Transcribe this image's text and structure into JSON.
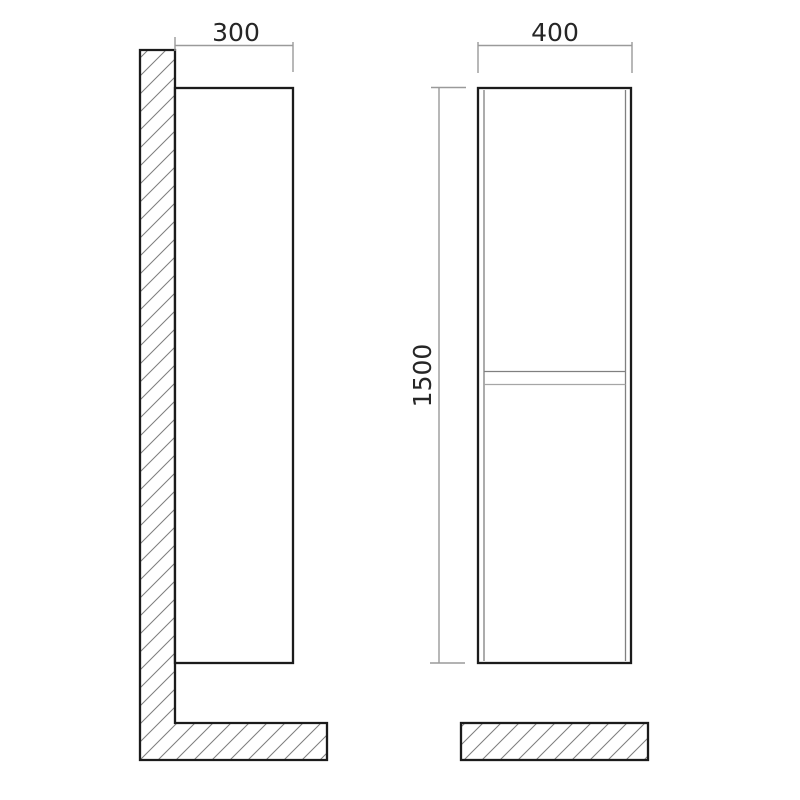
{
  "drawing": {
    "labels": {
      "side_depth": "300",
      "front_width": "400",
      "front_height": "1500"
    },
    "colors": {
      "background": "#ffffff",
      "outline": "#1b1b1b",
      "dimension": "#9a9a9a",
      "hatch": "#7e7e7e",
      "thin_edge": "#808080",
      "text": "#262626"
    }
  }
}
